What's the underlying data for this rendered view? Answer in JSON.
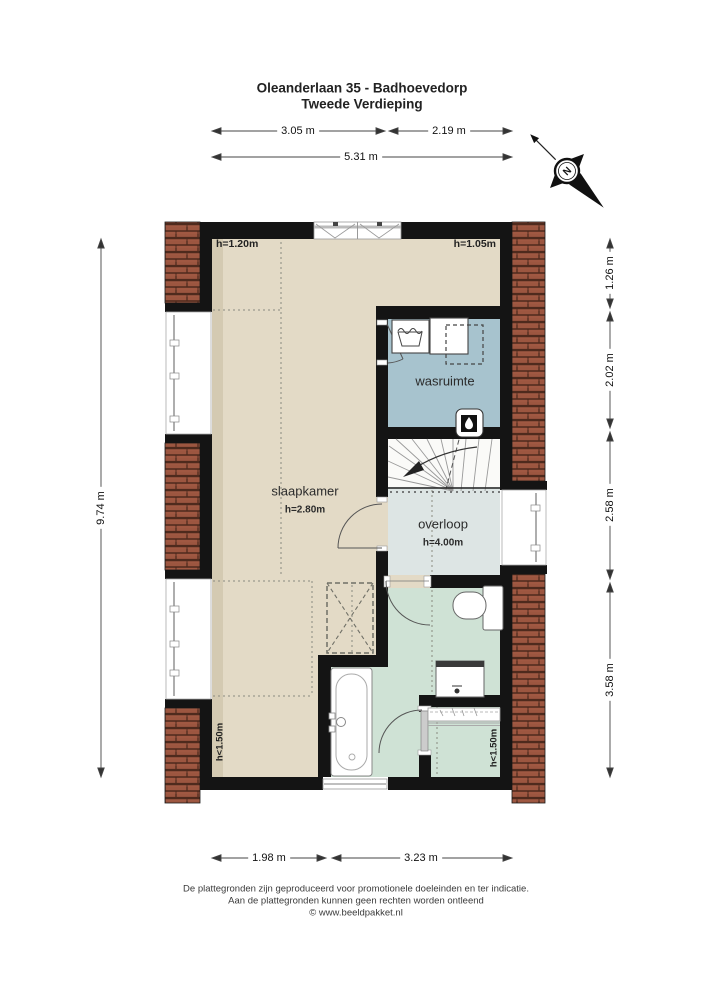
{
  "title": {
    "line1": "Oleanderlaan 35 - Badhoevedorp",
    "line2": "Tweede Verdieping"
  },
  "compass": {
    "label": "N"
  },
  "dimensions": {
    "top_row": {
      "seg1": "3.05 m",
      "seg2": "2.19 m"
    },
    "top_total": "5.31 m",
    "left_total": "9.74 m",
    "right": {
      "seg1": "1.26 m",
      "seg2": "2.02 m",
      "seg3": "2.58 m",
      "seg4": "3.58 m"
    },
    "bottom": {
      "seg1": "1.98 m",
      "seg2": "3.23 m"
    }
  },
  "rooms": {
    "slaapkamer": {
      "name": "slaapkamer",
      "ceiling": "h=2.80m"
    },
    "wasruimte": {
      "name": "wasruimte"
    },
    "overloop": {
      "name": "overloop",
      "ceiling": "h=4.00m"
    }
  },
  "height_labels": {
    "top_left": "h=1.20m",
    "top_right": "h=1.05m",
    "bottom_left": "h<1.50m",
    "bottom_right": "h<1.50m"
  },
  "footer": {
    "line1": "De plattegronden zijn geproduceerd voor promotionele doeleinden en ter indicatie.",
    "line2": "Aan de plattegronden kunnen geen rechten worden ontleend",
    "line3": "© www.beeldpakket.nl"
  },
  "colors": {
    "bedroom_floor": "#e3dac6",
    "laundry_floor": "#a7c3ce",
    "landing_floor": "#dde5e4",
    "bathroom_floor": "#cfe2d5",
    "stairs_floor": "#fafaf8",
    "roof_brick": "#9c5640",
    "wall": "#141414"
  },
  "icons": [
    "north-compass-icon",
    "washing-machine-icon",
    "laundry-tub-icon",
    "boiler-flame-icon",
    "stairs-icon",
    "bathtub-icon",
    "toilet-icon",
    "washbasin-icon",
    "radiator-icon",
    "window-icon",
    "door-arc-icon"
  ]
}
